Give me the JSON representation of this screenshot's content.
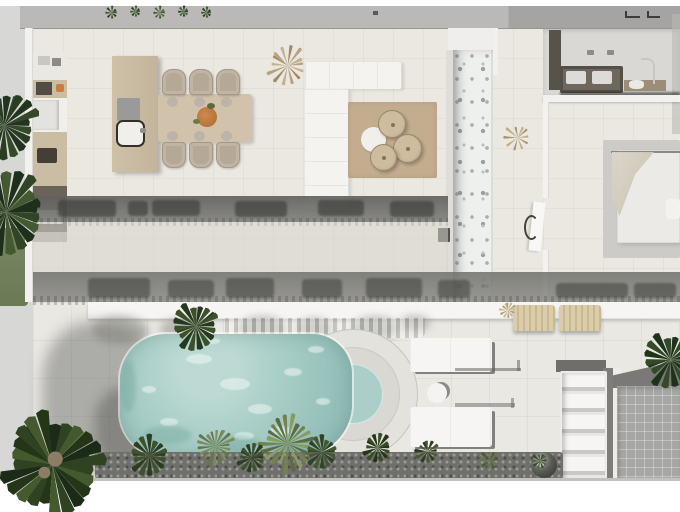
{
  "scene_type": "villa-floor-plan-3d-render",
  "palette": {
    "cream": "#ebe8e1",
    "deck": "#e9e8e3",
    "ground": "#d7d7d5",
    "topwall": "#bab9b7",
    "topwall_dark": "#a5a4a2",
    "wallwhite": "#f2f1ef",
    "stone": "#eef0ee",
    "water": "#a7cdc6",
    "water_light": "#bcd9d3",
    "water_deep": "#8db8b1",
    "step_water": "#abcfc8",
    "ring_outer": "#e3e2dd",
    "ring_mid": "#d9d8d3",
    "rug_tan": "#c4ad8e",
    "rug_gray": "#cccbc8",
    "wood": "#cbbca4",
    "wood_table": "#d1c3ab",
    "chair": "#b6a896",
    "sofa": "#f4f3f0",
    "dark_appliance": "#534c44",
    "vanity": "#544f48",
    "counter_wood": "#9b8d78",
    "pavers": "#a6a6a4",
    "gravel": "#6f6f6b",
    "sphere": "#2f2f2c",
    "lounger": "#d4c5a1",
    "bed": "#ebeae7",
    "drape": "#d5cfc0",
    "grass": "#74815f",
    "boundary": "#f6f5f3"
  },
  "objects": [
    "kitchen-counter",
    "kitchen-island",
    "induction-hob",
    "island-sink",
    "dining-table",
    "dining-chair",
    "table-centerpiece",
    "sofa",
    "living-rug",
    "coffee-table",
    "floor-pouf",
    "stone-accent-wall",
    "hallway-door",
    "bathroom-wardrobe",
    "bathroom-vanity",
    "vanity-sink",
    "basin-counter",
    "basin-faucet",
    "bedroom-rug",
    "bed",
    "bed-canopy-drape",
    "boundary-wall",
    "pool",
    "pool-steps",
    "pool-daybed",
    "pool-side-table",
    "sun-lounger",
    "outdoor-shelf",
    "decor-sphere",
    "paver-patio",
    "gravel-bed",
    "palm-tree",
    "agave-plant",
    "shrub",
    "grass-lawn",
    "planter-greenery",
    "window-glyph",
    "roof-vent"
  ],
  "counts": {
    "dining_chairs": 6,
    "coffee_tables": 3,
    "pool_daybeds": 2,
    "sun_loungers": 2,
    "shelf_slats": 5,
    "palms": 5
  },
  "pool": {
    "sparkles_light": [
      {
        "x": 66,
        "y": 20,
        "w": 26,
        "h": 10
      },
      {
        "x": 100,
        "y": 44,
        "w": 30,
        "h": 12
      },
      {
        "x": 128,
        "y": 70,
        "w": 24,
        "h": 10
      },
      {
        "x": 164,
        "y": 34,
        "w": 18,
        "h": 8
      },
      {
        "x": 40,
        "y": 84,
        "w": 18,
        "h": 8
      },
      {
        "x": 188,
        "y": 12,
        "w": 16,
        "h": 7
      },
      {
        "x": 150,
        "y": 92,
        "w": 22,
        "h": 9
      },
      {
        "x": 22,
        "y": 52,
        "w": 14,
        "h": 7
      },
      {
        "x": 84,
        "y": 4,
        "w": 16,
        "h": 6
      },
      {
        "x": 114,
        "y": 98,
        "w": 20,
        "h": 8
      },
      {
        "x": 196,
        "y": 64,
        "w": 14,
        "h": 7
      }
    ],
    "shadows_dark": [
      {
        "x": 24,
        "y": 92,
        "w": 48,
        "h": 18
      },
      {
        "x": 84,
        "y": 102,
        "w": 56,
        "h": 16
      },
      {
        "x": 146,
        "y": 106,
        "w": 42,
        "h": 13
      },
      {
        "x": 0,
        "y": 26,
        "w": 16,
        "h": 52
      }
    ]
  },
  "plants": [
    {
      "name": "palm-tree",
      "x": 52,
      "y": 464,
      "r": 54,
      "fronds": 26,
      "trunk": true,
      "thin": false,
      "colors": [
        "#1c2a18",
        "#2f4322",
        "#44592e",
        "#253618"
      ]
    },
    {
      "name": "palm-tree",
      "x": 4,
      "y": 125,
      "r": 36,
      "fronds": 20,
      "trunk": false,
      "thin": false,
      "colors": [
        "#223420",
        "#35492a",
        "#2a3d23"
      ]
    },
    {
      "name": "palm-tree",
      "x": 6,
      "y": 212,
      "r": 44,
      "fronds": 22,
      "trunk": false,
      "thin": false,
      "colors": [
        "#1e301c",
        "#314526",
        "#445832"
      ]
    },
    {
      "name": "palm-tree",
      "x": 196,
      "y": 326,
      "r": 26,
      "fronds": 18,
      "trunk": false,
      "thin": false,
      "colors": [
        "#26391f",
        "#3c5129"
      ]
    },
    {
      "name": "palm-tree",
      "x": 671,
      "y": 360,
      "r": 30,
      "fronds": 18,
      "trunk": false,
      "thin": false,
      "colors": [
        "#1f3319",
        "#35492a"
      ]
    },
    {
      "name": "agave-plant",
      "x": 288,
      "y": 444,
      "r": 30,
      "fronds": 24,
      "trunk": false,
      "thin": true,
      "colors": [
        "#73824f",
        "#8a9a63",
        "#5c6b40"
      ]
    },
    {
      "name": "agave-plant",
      "x": 215,
      "y": 446,
      "r": 20,
      "fronds": 20,
      "trunk": false,
      "thin": true,
      "colors": [
        "#66754a",
        "#7d8c58"
      ]
    },
    {
      "name": "shrub",
      "x": 150,
      "y": 456,
      "r": 22,
      "fronds": 16,
      "trunk": false,
      "thin": false,
      "colors": [
        "#2c3d24",
        "#3e5230"
      ]
    },
    {
      "name": "shrub",
      "x": 252,
      "y": 458,
      "r": 16,
      "fronds": 14,
      "trunk": false,
      "thin": false,
      "colors": [
        "#2c3d24",
        "#3e5230"
      ]
    },
    {
      "name": "shrub",
      "x": 322,
      "y": 452,
      "r": 18,
      "fronds": 16,
      "trunk": false,
      "thin": false,
      "colors": [
        "#314228",
        "#455834"
      ]
    },
    {
      "name": "shrub",
      "x": 378,
      "y": 448,
      "r": 16,
      "fronds": 14,
      "trunk": false,
      "thin": false,
      "colors": [
        "#243619",
        "#384d26"
      ]
    },
    {
      "name": "shrub",
      "x": 428,
      "y": 452,
      "r": 13,
      "fronds": 12,
      "trunk": false,
      "thin": false,
      "colors": [
        "#2c3d24",
        "#465932"
      ]
    },
    {
      "name": "shrub",
      "x": 490,
      "y": 460,
      "r": 11,
      "fronds": 10,
      "trunk": false,
      "thin": false,
      "colors": [
        "#4c5c38",
        "#667647"
      ]
    },
    {
      "name": "shrub",
      "x": 540,
      "y": 461,
      "r": 9,
      "fronds": 10,
      "trunk": false,
      "thin": false,
      "colors": [
        "#3a4a2c",
        "#556741"
      ]
    },
    {
      "name": "decor-frond",
      "x": 288,
      "y": 66,
      "r": 22,
      "fronds": 14,
      "trunk": false,
      "thin": true,
      "colors": [
        "#b7a27f",
        "#c4b192",
        "#a08b68"
      ]
    },
    {
      "name": "dried-leaf",
      "x": 518,
      "y": 138,
      "r": 15,
      "fronds": 10,
      "trunk": false,
      "thin": true,
      "colors": [
        "#c2ad88",
        "#ab9470"
      ]
    },
    {
      "name": "grass-tuft",
      "x": 508,
      "y": 310,
      "r": 9,
      "fronds": 12,
      "trunk": false,
      "thin": true,
      "colors": [
        "#c9b98e",
        "#b3a279"
      ]
    },
    {
      "name": "planter-sprig",
      "x": 112,
      "y": 13,
      "r": 7,
      "fronds": 8,
      "trunk": false,
      "thin": true,
      "colors": [
        "#3f5631",
        "#2c4023"
      ]
    },
    {
      "name": "planter-sprig",
      "x": 136,
      "y": 12,
      "r": 6,
      "fronds": 8,
      "trunk": false,
      "thin": true,
      "colors": [
        "#46603a",
        "#2c4023"
      ]
    },
    {
      "name": "planter-sprig",
      "x": 160,
      "y": 13,
      "r": 7,
      "fronds": 8,
      "trunk": false,
      "thin": true,
      "colors": [
        "#3f5631",
        "#556a3e"
      ]
    },
    {
      "name": "planter-sprig",
      "x": 184,
      "y": 12,
      "r": 6,
      "fronds": 8,
      "trunk": false,
      "thin": true,
      "colors": [
        "#2c4023",
        "#46603a"
      ]
    },
    {
      "name": "planter-sprig",
      "x": 207,
      "y": 13,
      "r": 6,
      "fronds": 8,
      "trunk": false,
      "thin": true,
      "colors": [
        "#3f5631",
        "#2c4023"
      ]
    }
  ]
}
